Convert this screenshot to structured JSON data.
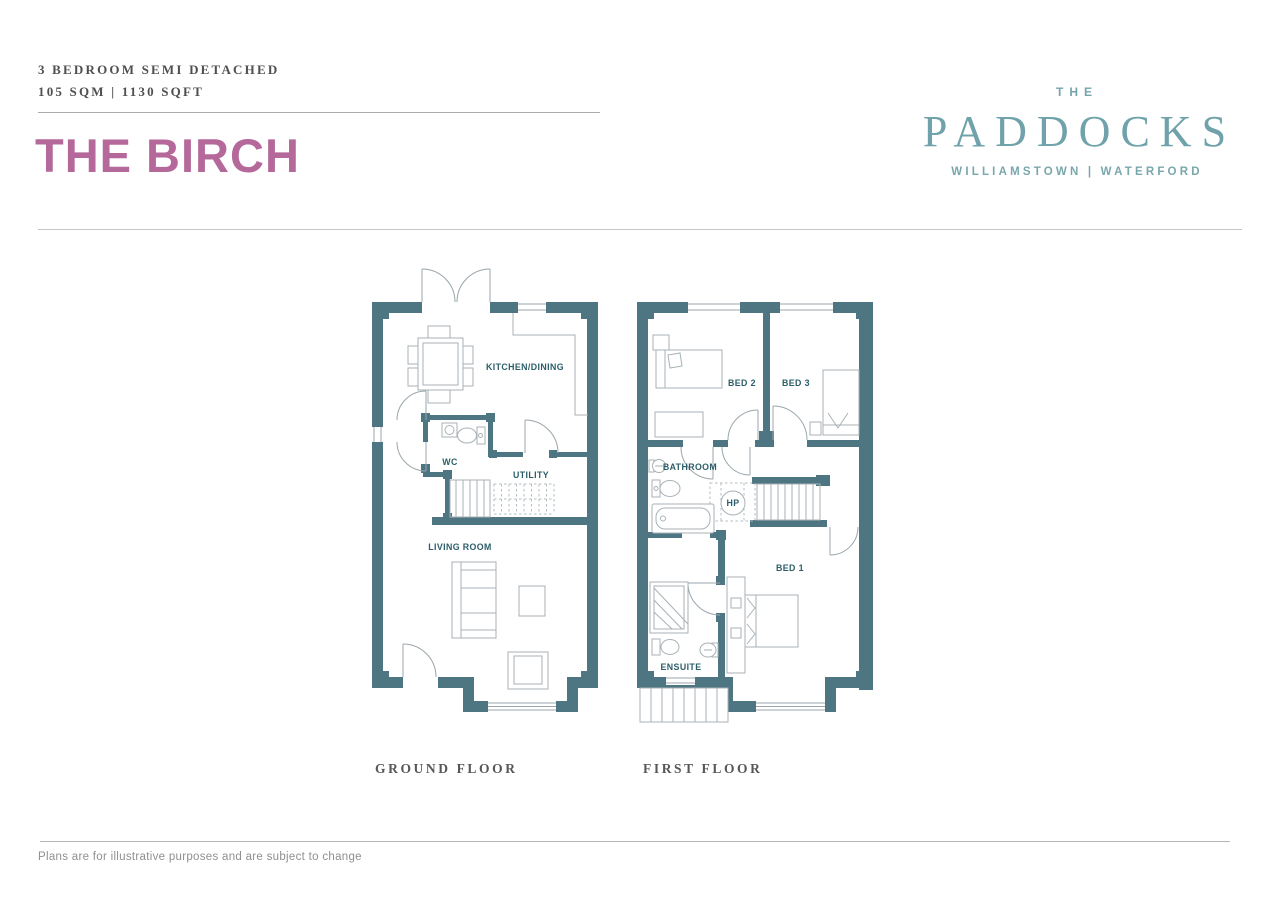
{
  "header": {
    "type_line": "3 BEDROOM SEMI DETACHED",
    "size_line": "105 SQM | 1130 SQFT",
    "title": "THE BIRCH"
  },
  "brand": {
    "prefix": "THE",
    "name": "PADDOCKS",
    "location": "WILLIAMSTOWN | WATERFORD"
  },
  "plans": {
    "ground": {
      "label": "GROUND FLOOR",
      "rooms": {
        "kitchen_dining": "KITCHEN/DINING",
        "wc": "WC",
        "utility": "UTILITY",
        "living_room": "LIVING ROOM"
      }
    },
    "first": {
      "label": "FIRST FLOOR",
      "rooms": {
        "bed2": "BED 2",
        "bed3": "BED 3",
        "bathroom": "BATHROOM",
        "hot_press": "HP",
        "bed1": "BED 1",
        "ensuite": "ENSUITE"
      }
    }
  },
  "footer": {
    "disclaimer": "Plans are for illustrative purposes and are subject to change"
  },
  "colors": {
    "wall_teal": "#4e7582",
    "room_label_teal": "#2b5e69",
    "title_pink": "#b4699a",
    "brand_teal": "#74a5ac"
  }
}
